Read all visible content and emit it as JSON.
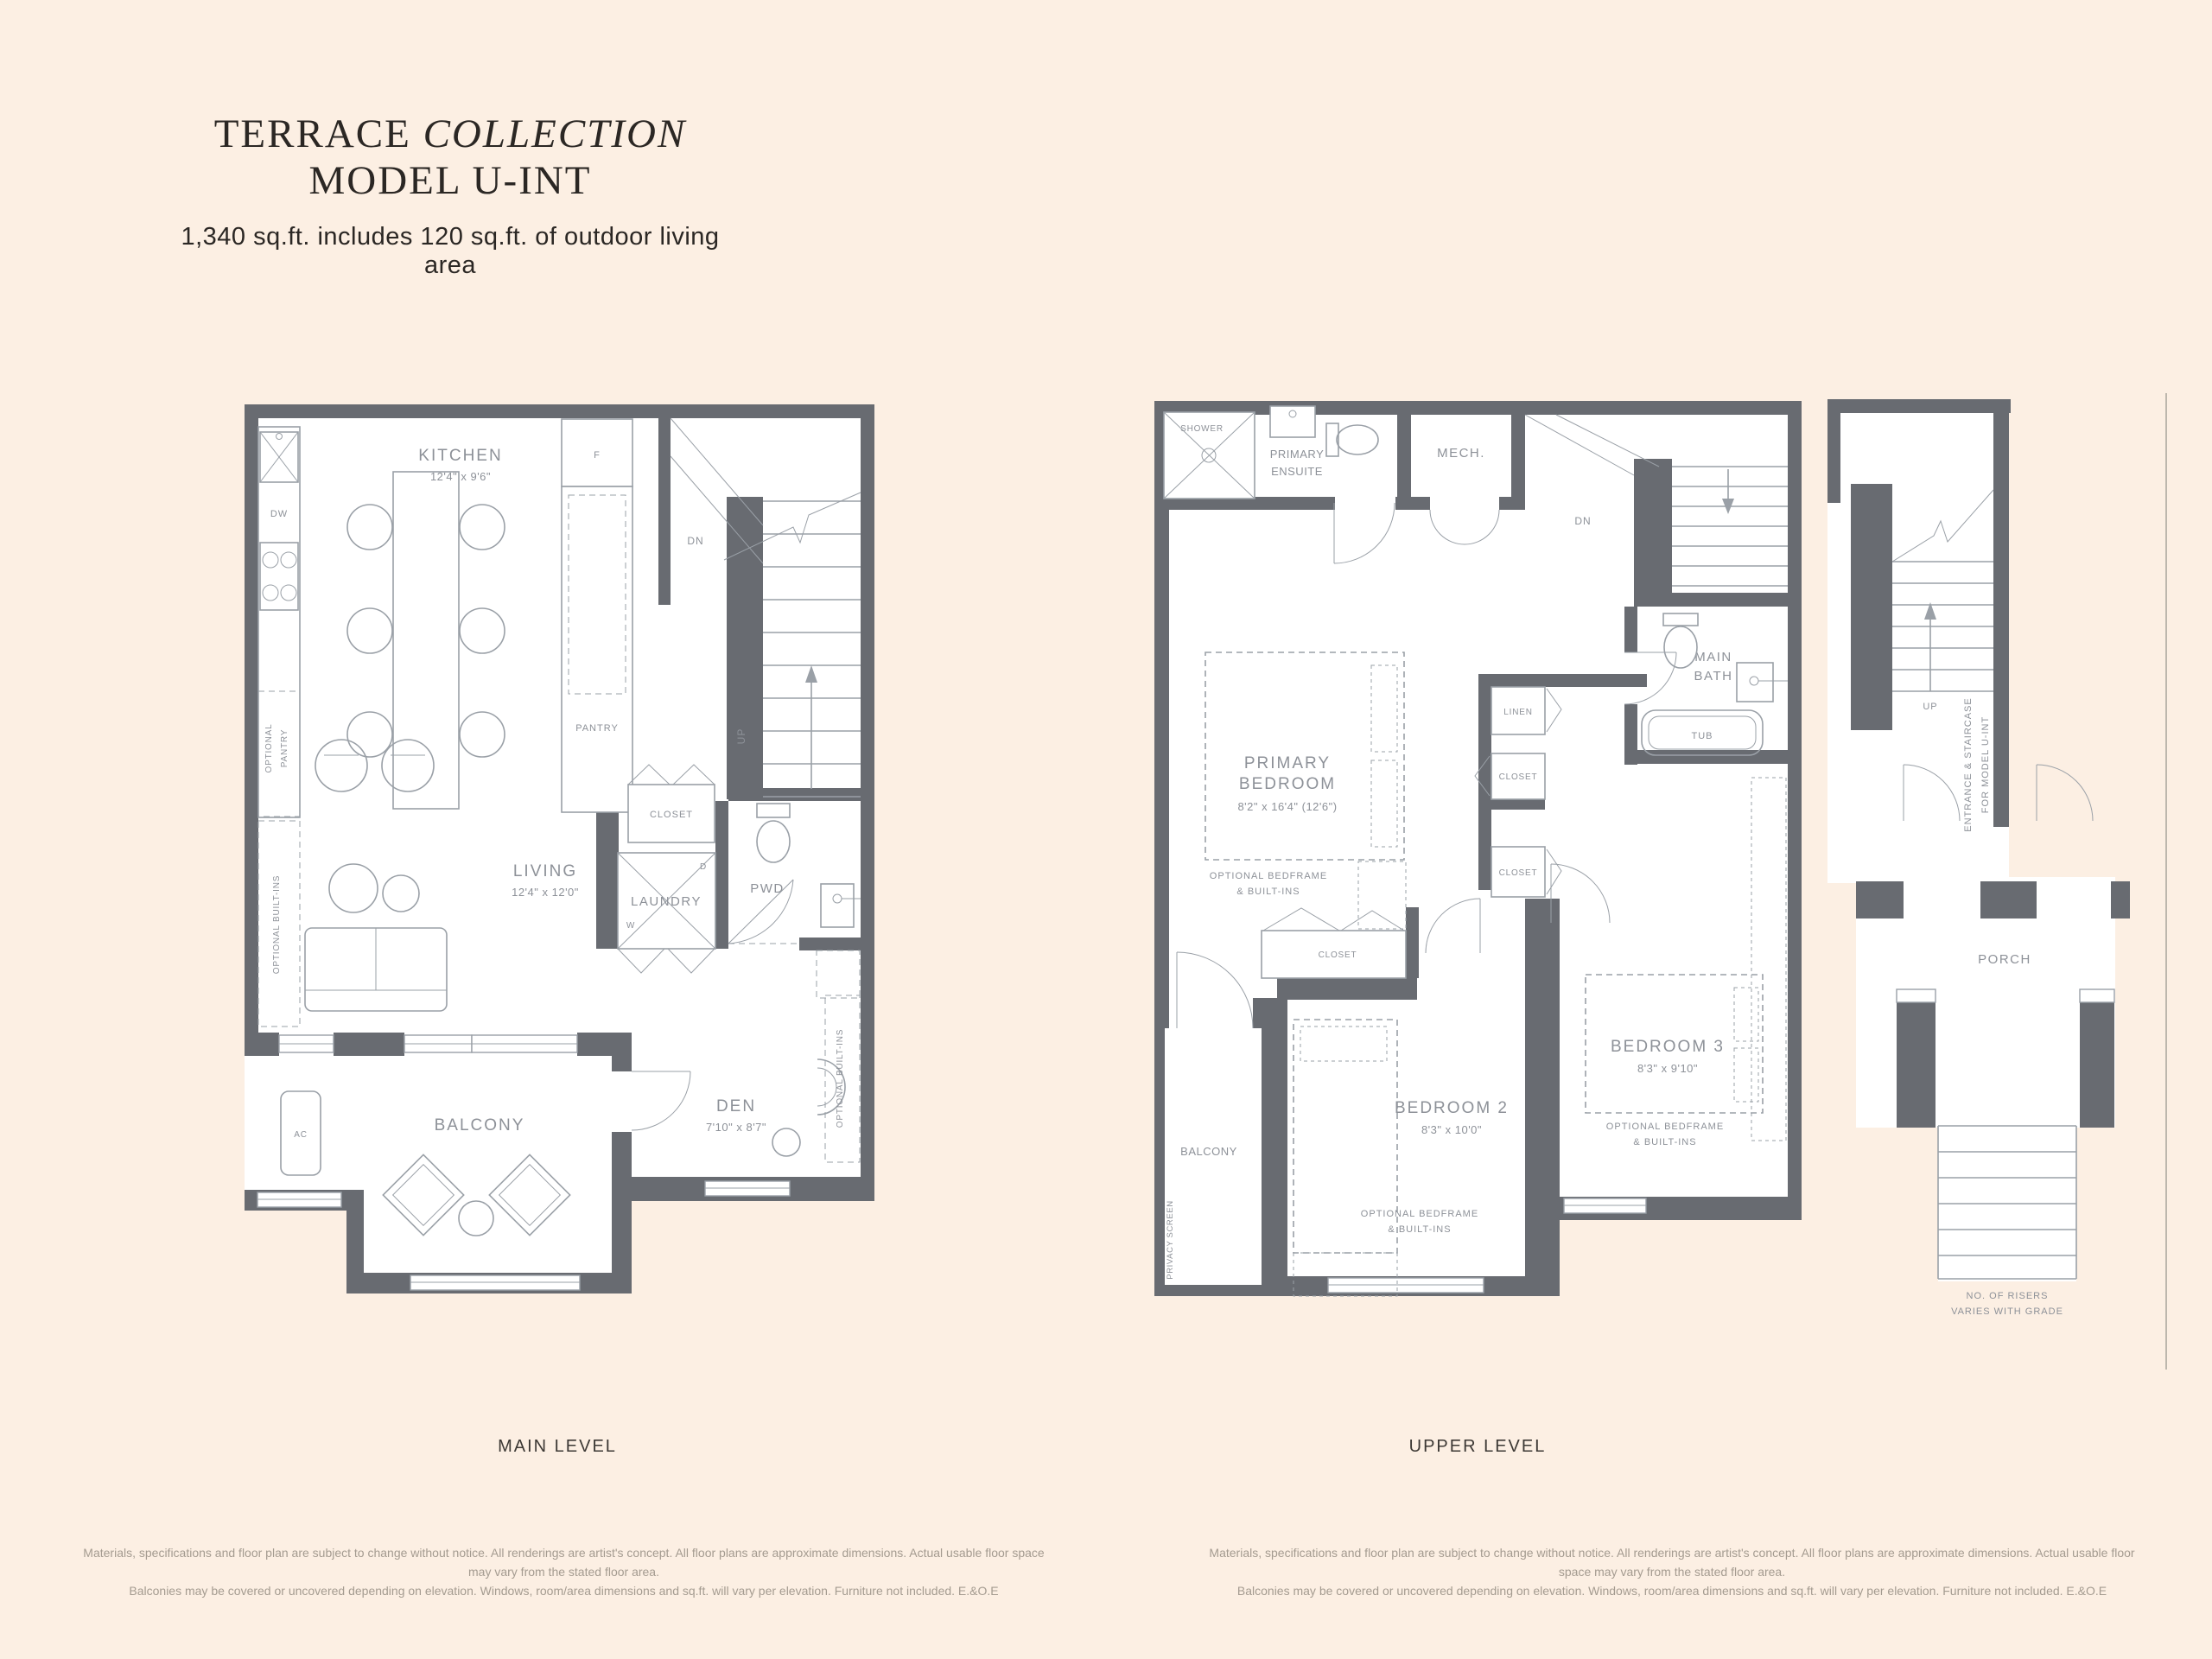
{
  "colors": {
    "background": "#fcefe3",
    "wall": "#686b71",
    "linework": "#9aa0a7",
    "plan_label": "#8d9198",
    "heading": "#2b2724",
    "caption": "#3c3834",
    "disclaimer": "#a49b90"
  },
  "header": {
    "title_regular": "TERRACE ",
    "title_italic": "COLLECTION",
    "title_line2": "MODEL U-INT",
    "subtitle": "1,340 sq.ft. includes 120 sq.ft. of outdoor living area"
  },
  "main_level": {
    "caption": "MAIN LEVEL",
    "kitchen": {
      "name": "KITCHEN",
      "dim": "12'4\" x 9'6\""
    },
    "living": {
      "name": "LIVING",
      "dim": "12'4\" x 12'0\""
    },
    "den": {
      "name": "DEN",
      "dim": "7'10\" x 8'7\""
    },
    "balcony": "BALCONY",
    "pwd": "PWD",
    "laundry": "LAUNDRY",
    "closet": "CLOSET",
    "pantry": "PANTRY",
    "fridge": "F",
    "dishwasher": "DW",
    "ac": "AC",
    "dryer": "D",
    "washer": "W",
    "dn": "DN",
    "up": "UP",
    "optional_pantry_1": "OPTIONAL",
    "optional_pantry_2": "PANTRY",
    "optional_builtins_left": "OPTIONAL BUILT-INS",
    "optional_builtins_den": "OPTIONAL BUILT-INS"
  },
  "upper_level": {
    "caption": "UPPER LEVEL",
    "shower": "SHOWER",
    "primary_ensuite_1": "PRIMARY",
    "primary_ensuite_2": "ENSUITE",
    "mech": "MECH.",
    "dn": "DN",
    "linen": "LINEN",
    "closet_1": "CLOSET",
    "closet_2": "CLOSET",
    "closet_primary": "CLOSET",
    "primary_bedroom": {
      "name_1": "PRIMARY",
      "name_2": "BEDROOM",
      "dim": "8'2\" x 16'4\" (12'6\")"
    },
    "optional_bedframe_1": "OPTIONAL BEDFRAME",
    "optional_bedframe_2": "& BUILT-INS",
    "main_bath_1": "MAIN",
    "main_bath_2": "BATH",
    "tub": "TUB",
    "bedroom2": {
      "name": "BEDROOM 2",
      "dim": "8'3\" x 10'0\""
    },
    "bedroom3": {
      "name": "BEDROOM 3",
      "dim": "8'3\" x 9'10\""
    },
    "balcony": "BALCONY",
    "privacy_screen": "PRIVACY SCREEN"
  },
  "entrance": {
    "up": "UP",
    "stair_label_1": "ENTRANCE & STAIRCASE",
    "stair_label_2": "FOR MODEL U-INT",
    "porch": "PORCH",
    "risers_1": "NO. OF RISERS",
    "risers_2": "VARIES WITH GRADE"
  },
  "disclaimer": {
    "line1": "Materials, specifications and floor plan are subject to change without notice. All renderings are artist's concept. All floor plans are approximate dimensions. Actual usable floor space may vary from the stated floor area.",
    "line2": "Balconies may be covered or uncovered depending on elevation. Windows, room/area dimensions and sq.ft. will vary per elevation. Furniture not included. E.&O.E"
  }
}
